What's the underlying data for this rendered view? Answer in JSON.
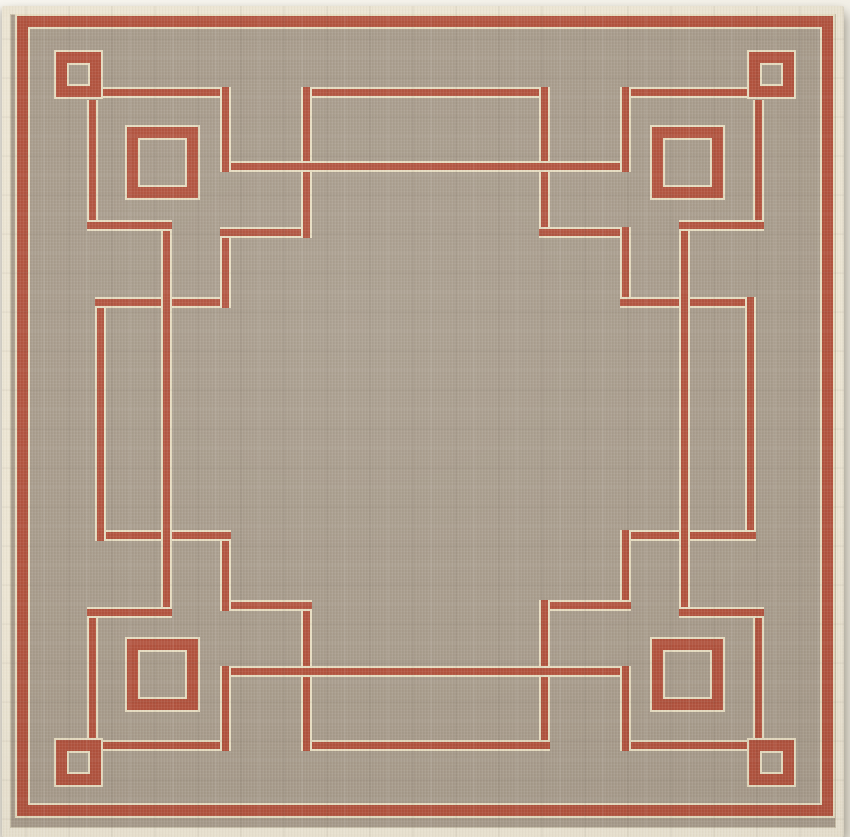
{
  "image": {
    "kind": "product-photo",
    "subject": "square flat-weave outdoor area rug",
    "description": "Taupe rug with rust-red Greek-key fretwork border, red perimeter stripe, small and large open squares in each corner, cream bound edge on a white background"
  },
  "palette": {
    "background": "#f5f3ec",
    "binding_cream": "#ece5d3",
    "field_taupe": "#a89c8c",
    "accent_red": "#b2533e",
    "edging_cream": "#e6dcc0"
  },
  "rug": {
    "canvas": {
      "w": 850,
      "h": 837
    },
    "offset": {
      "left": 2,
      "top": 6,
      "width": 842,
      "height": 831
    },
    "stroke": 11,
    "perimeter": {
      "x": 17,
      "y": 16,
      "w": 816,
      "h": 800
    },
    "squares": [
      {
        "x": 56,
        "y": 52,
        "s": 45
      },
      {
        "x": 749,
        "y": 52,
        "s": 45
      },
      {
        "x": 56,
        "y": 740,
        "s": 45
      },
      {
        "x": 749,
        "y": 740,
        "s": 45
      },
      {
        "x": 127,
        "y": 127,
        "s": 71
      },
      {
        "x": 652,
        "y": 127,
        "s": 71
      },
      {
        "x": 127,
        "y": 639,
        "s": 71
      },
      {
        "x": 652,
        "y": 639,
        "s": 71
      }
    ],
    "segments": [
      {
        "t": "h",
        "x": 300.5,
        "y": 86.5,
        "w": 249,
        "h": 11
      },
      {
        "t": "v",
        "x": 538.5,
        "y": 86.5,
        "w": 11,
        "h": 151
      },
      {
        "t": "h",
        "x": 538.5,
        "y": 226.5,
        "w": 92,
        "h": 11
      },
      {
        "t": "v",
        "x": 619.5,
        "y": 226.5,
        "w": 11,
        "h": 81
      },
      {
        "t": "h",
        "x": 619.5,
        "y": 296.5,
        "w": 136,
        "h": 11
      },
      {
        "t": "v",
        "x": 744.5,
        "y": 296.5,
        "w": 11,
        "h": 244
      },
      {
        "t": "h",
        "x": 619.5,
        "y": 529.5,
        "w": 136,
        "h": 11
      },
      {
        "t": "v",
        "x": 619.5,
        "y": 529.5,
        "w": 11,
        "h": 81
      },
      {
        "t": "h",
        "x": 538.5,
        "y": 599.5,
        "w": 92,
        "h": 11
      },
      {
        "t": "v",
        "x": 538.5,
        "y": 599.5,
        "w": 11,
        "h": 151
      },
      {
        "t": "h",
        "x": 300.5,
        "y": 739.5,
        "w": 249,
        "h": 11
      },
      {
        "t": "v",
        "x": 300.5,
        "y": 599.5,
        "w": 11,
        "h": 151
      },
      {
        "t": "h",
        "x": 219.5,
        "y": 599.5,
        "w": 92,
        "h": 11
      },
      {
        "t": "v",
        "x": 219.5,
        "y": 529.5,
        "w": 11,
        "h": 81
      },
      {
        "t": "h",
        "x": 94.5,
        "y": 529.5,
        "w": 136,
        "h": 11
      },
      {
        "t": "v",
        "x": 94.5,
        "y": 296.5,
        "w": 11,
        "h": 244
      },
      {
        "t": "h",
        "x": 94.5,
        "y": 296.5,
        "w": 136,
        "h": 11
      },
      {
        "t": "v",
        "x": 219.5,
        "y": 226.5,
        "w": 11,
        "h": 81
      },
      {
        "t": "h",
        "x": 219.5,
        "y": 226.5,
        "w": 92,
        "h": 11
      },
      {
        "t": "v",
        "x": 300.5,
        "y": 86.5,
        "w": 11,
        "h": 151
      },
      {
        "t": "h",
        "x": 219.5,
        "y": 160.5,
        "w": 411,
        "h": 11
      },
      {
        "t": "h",
        "x": 219.5,
        "y": 665.5,
        "w": 411,
        "h": 11
      },
      {
        "t": "v",
        "x": 160.5,
        "y": 219.5,
        "w": 11,
        "h": 398
      },
      {
        "t": "v",
        "x": 678.5,
        "y": 219.5,
        "w": 11,
        "h": 398
      },
      {
        "t": "h",
        "x": 100,
        "y": 86.5,
        "w": 131,
        "h": 11
      },
      {
        "t": "v",
        "x": 219.5,
        "y": 86.5,
        "w": 11,
        "h": 85
      },
      {
        "t": "v",
        "x": 86.5,
        "y": 100,
        "w": 11,
        "h": 131
      },
      {
        "t": "h",
        "x": 86.5,
        "y": 219.5,
        "w": 85,
        "h": 11
      },
      {
        "t": "h",
        "x": 619.5,
        "y": 86.5,
        "w": 131,
        "h": 11
      },
      {
        "t": "v",
        "x": 619.5,
        "y": 86.5,
        "w": 11,
        "h": 85
      },
      {
        "t": "v",
        "x": 752.5,
        "y": 100,
        "w": 11,
        "h": 131
      },
      {
        "t": "h",
        "x": 678.5,
        "y": 219.5,
        "w": 85,
        "h": 11
      },
      {
        "t": "h",
        "x": 100,
        "y": 739.5,
        "w": 131,
        "h": 11
      },
      {
        "t": "v",
        "x": 219.5,
        "y": 665.5,
        "w": 11,
        "h": 85
      },
      {
        "t": "v",
        "x": 86.5,
        "y": 606.5,
        "w": 11,
        "h": 131
      },
      {
        "t": "h",
        "x": 86.5,
        "y": 606.5,
        "w": 85,
        "h": 11
      },
      {
        "t": "h",
        "x": 619.5,
        "y": 739.5,
        "w": 131,
        "h": 11
      },
      {
        "t": "v",
        "x": 619.5,
        "y": 665.5,
        "w": 11,
        "h": 85
      },
      {
        "t": "v",
        "x": 752.5,
        "y": 606.5,
        "w": 11,
        "h": 131
      },
      {
        "t": "h",
        "x": 678.5,
        "y": 606.5,
        "w": 85,
        "h": 11
      }
    ]
  }
}
